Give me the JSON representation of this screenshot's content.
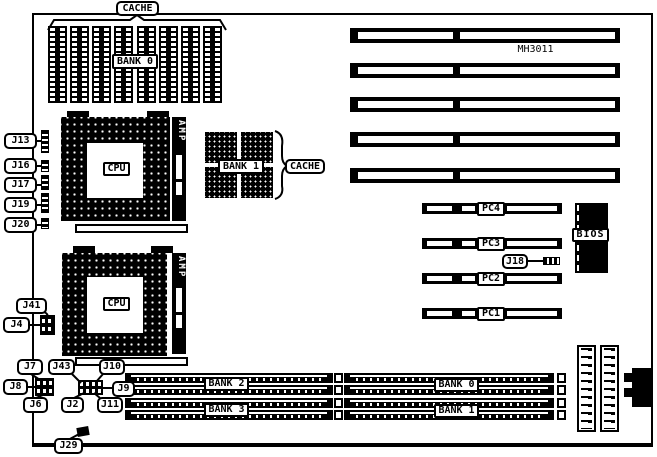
{
  "colors": {
    "ink": "#000000",
    "paper": "#ffffff"
  },
  "board": {
    "model": "MH3011"
  },
  "cache": {
    "top_label": "CACHE",
    "dip_bank": "BANK 0",
    "sram_bank": "BANK 1",
    "right_label": "CACHE"
  },
  "cpu": {
    "socket1": "CPU",
    "socket2": "CPU",
    "amp1": "AMP",
    "amp2": "AMP"
  },
  "bios": {
    "label": "BIOS"
  },
  "pci_slots": [
    "PC4",
    "PC3",
    "PC2",
    "PC1"
  ],
  "simm": {
    "left_banks": [
      "BANK 2",
      "BANK 3"
    ],
    "right_banks": [
      "BANK 0",
      "BANK 1"
    ]
  },
  "jumpers": {
    "left_column": [
      "J13",
      "J16",
      "J17",
      "J19",
      "J20"
    ],
    "j41": "J41",
    "j4": "J4",
    "j7": "J7",
    "j8": "J8",
    "j6": "J6",
    "j43": "J43",
    "j10": "J10",
    "j9": "J9",
    "j2": "J2",
    "j11": "J11",
    "j29": "J29",
    "j18": "J18"
  }
}
